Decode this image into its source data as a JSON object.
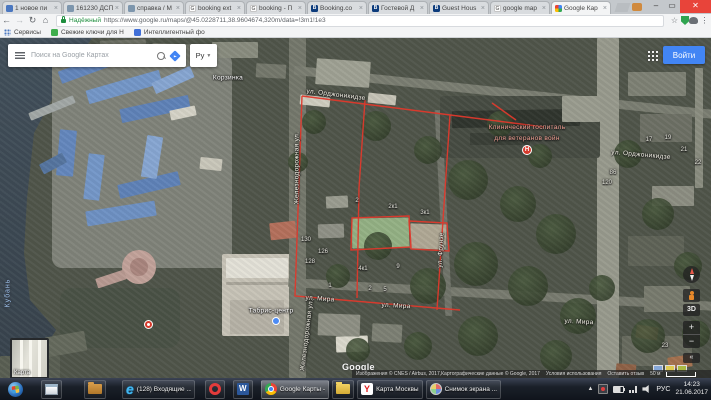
{
  "browser": {
    "tabs": [
      {
        "label": "1 новое пи",
        "favicon": "mail"
      },
      {
        "label": "161230 ДСП",
        "favicon": "doc"
      },
      {
        "label": "справка / М",
        "favicon": "doc"
      },
      {
        "label": "booking ext",
        "favicon": "g"
      },
      {
        "label": "booking - П",
        "favicon": "g"
      },
      {
        "label": "Booking.co",
        "favicon": "b"
      },
      {
        "label": "Гостевой Д",
        "favicon": "b"
      },
      {
        "label": "Guest Hous",
        "favicon": "b"
      },
      {
        "label": "google map",
        "favicon": "g"
      },
      {
        "label": "Google Кар",
        "favicon": "maps",
        "active": true
      }
    ],
    "address": {
      "security_label": "Надёжный",
      "url": "https://www.google.ru/maps/@45.0228711,38.9604674,320m/data=!3m1!1e3"
    },
    "bookmarks": [
      {
        "label": "Сервисы",
        "icon": "apps-grid"
      },
      {
        "label": "Свежие ключи для Н",
        "icon": "green-badge"
      },
      {
        "label": "Интеллигентный фо",
        "icon": "blue-badge"
      }
    ]
  },
  "maps_ui": {
    "search_placeholder": "Поиск на Google Картах",
    "language_button": "Ру",
    "signin_button": "Войти",
    "controls": {
      "three_d": "3D",
      "zoom_in": "+",
      "zoom_out": "−",
      "collapse": "«"
    },
    "map_type_thumbnail": "Карта",
    "google_logo": "Google",
    "attribution": {
      "imagery": "Изображения © CNES / Airbus, 2017,Картографические данные © Google, 2017",
      "terms": "Условия использования",
      "feedback": "Оставить отзыв",
      "scale": "50 м"
    }
  },
  "map": {
    "river_label": "Кубань",
    "street_labels": [
      {
        "text": "ул. Орджоникидзе",
        "x": 336,
        "y": 57,
        "rot": 7
      },
      {
        "text": "ул. Орджоникидзе",
        "x": 641,
        "y": 117,
        "rot": 5
      },
      {
        "text": "Железнодорожная ул.",
        "x": 297,
        "y": 130,
        "rot": -90
      },
      {
        "text": "Железнодорожная ул.",
        "x": 307,
        "y": 297,
        "rot": -83
      },
      {
        "text": "ул. Фрунзе",
        "x": 441,
        "y": 212,
        "rot": -87
      },
      {
        "text": "ул. Мира",
        "x": 320,
        "y": 261,
        "rot": 4
      },
      {
        "text": "ул. Мира",
        "x": 396,
        "y": 268,
        "rot": 3
      },
      {
        "text": "ул. Мира",
        "x": 579,
        "y": 284,
        "rot": 3
      }
    ],
    "poi_labels": [
      {
        "text": "Корзинка",
        "x": 228,
        "y": 40,
        "cls": "poi-shop"
      },
      {
        "text": "Табрис-центр",
        "x": 271,
        "y": 273,
        "cls": "poi-shop"
      },
      {
        "text": "Клинический госпиталь\nдля ветеранов войн",
        "x": 527,
        "y": 95,
        "cls": "poi-hospital"
      }
    ],
    "house_numbers": [
      {
        "n": "130",
        "x": 306,
        "y": 202
      },
      {
        "n": "126",
        "x": 323,
        "y": 214
      },
      {
        "n": "128",
        "x": 310,
        "y": 224
      },
      {
        "n": "2",
        "x": 357,
        "y": 163
      },
      {
        "n": "2к1",
        "x": 393,
        "y": 169
      },
      {
        "n": "3к1",
        "x": 425,
        "y": 175
      },
      {
        "n": "4к1",
        "x": 363,
        "y": 231
      },
      {
        "n": "9",
        "x": 398,
        "y": 229
      },
      {
        "n": "2",
        "x": 370,
        "y": 251
      },
      {
        "n": "5",
        "x": 385,
        "y": 252
      },
      {
        "n": "1",
        "x": 330,
        "y": 248
      },
      {
        "n": "17",
        "x": 649,
        "y": 102
      },
      {
        "n": "19",
        "x": 668,
        "y": 100
      },
      {
        "n": "21",
        "x": 684,
        "y": 112
      },
      {
        "n": "22",
        "x": 698,
        "y": 125
      },
      {
        "n": "86",
        "x": 613,
        "y": 135
      },
      {
        "n": "120",
        "x": 607,
        "y": 145
      },
      {
        "n": "23",
        "x": 665,
        "y": 308
      }
    ]
  },
  "taskbar": {
    "items": [
      {
        "icon": "start",
        "label": ""
      },
      {
        "icon": "explorer",
        "label": ""
      },
      {
        "icon": "folder",
        "label": ""
      },
      {
        "icon": "ie",
        "label": "(128) Входящие ..."
      },
      {
        "icon": "opera",
        "label": ""
      },
      {
        "icon": "word",
        "label": ""
      },
      {
        "icon": "chrome",
        "label": "Google Карты -",
        "active": true
      },
      {
        "icon": "folder-yellow",
        "label": ""
      },
      {
        "icon": "yandex",
        "label": "Карта Москвы"
      },
      {
        "icon": "paint",
        "label": "Снимок экрана ..."
      }
    ],
    "tray": {
      "lang": "РУС",
      "time": "14:23",
      "date": "21.06.2017"
    }
  }
}
